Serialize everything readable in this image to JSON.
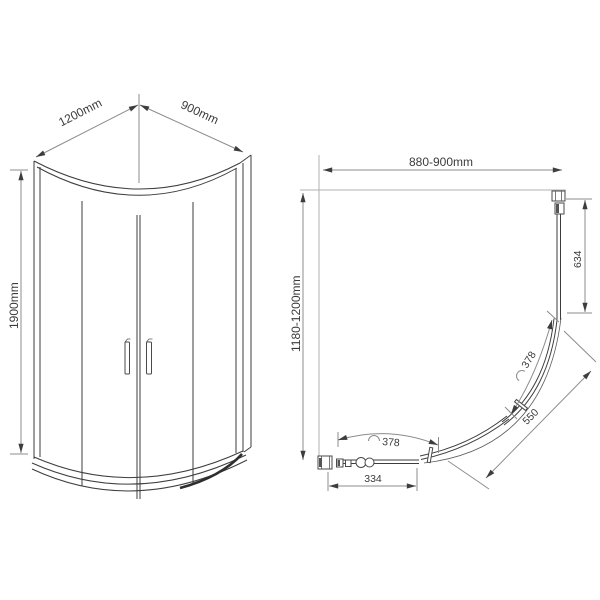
{
  "title": "quadrant-shower-enclosure-technical-drawing",
  "colors": {
    "ink": "#3d3d3d",
    "dimension": "#8c8c8c",
    "wall": "#b0b0b0",
    "background": "#ffffff"
  },
  "front_view": {
    "width_label": "1200mm",
    "depth_label": "900mm",
    "height_label": "1900mm"
  },
  "plan_view": {
    "width_label": "880-900mm",
    "depth_label": "1180-1200mm",
    "side_panel_label": "634",
    "door_arc_right_label": "378",
    "door_arc_bottom_label": "378",
    "radius_label": "550",
    "bottom_panel_label": "334"
  }
}
